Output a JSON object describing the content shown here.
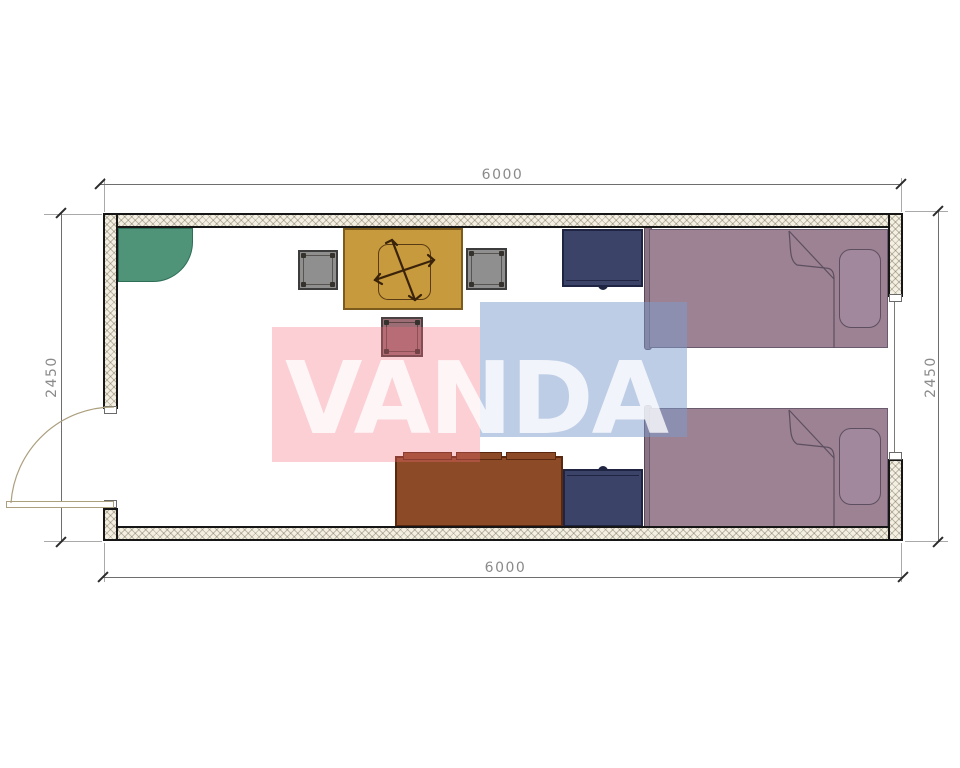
{
  "plan": {
    "title": "container-room-floor-plan",
    "watermark_text": "VANDA",
    "dimension_labels": {
      "top": "6000",
      "bottom": "6000",
      "left": "2450",
      "right": "2450"
    },
    "furniture": [
      "corner-shelf",
      "desk",
      "desk-chair-cross",
      "stool-left",
      "stool-right",
      "stool-front",
      "nightstand-top",
      "nightstand-bottom",
      "sofa",
      "bed-top",
      "bed-bottom",
      "entry-door",
      "window"
    ],
    "colors": {
      "wall_hatch_bg": "#f3efe2",
      "wall_outline": "#161616",
      "corner_shelf": "#4f9378",
      "desk": "#c79a3d",
      "stool_gray": "#8f8f8f",
      "stool_mauve": "#9c6d75",
      "nightstand_navy": "#3c4368",
      "sofa_brown": "#8c4a26",
      "bed_mauve": "#9c8292",
      "watermark_pink": "#f26c7a",
      "watermark_blue": "#7d9bcd",
      "dimension_text": "#8a8a8a"
    }
  }
}
